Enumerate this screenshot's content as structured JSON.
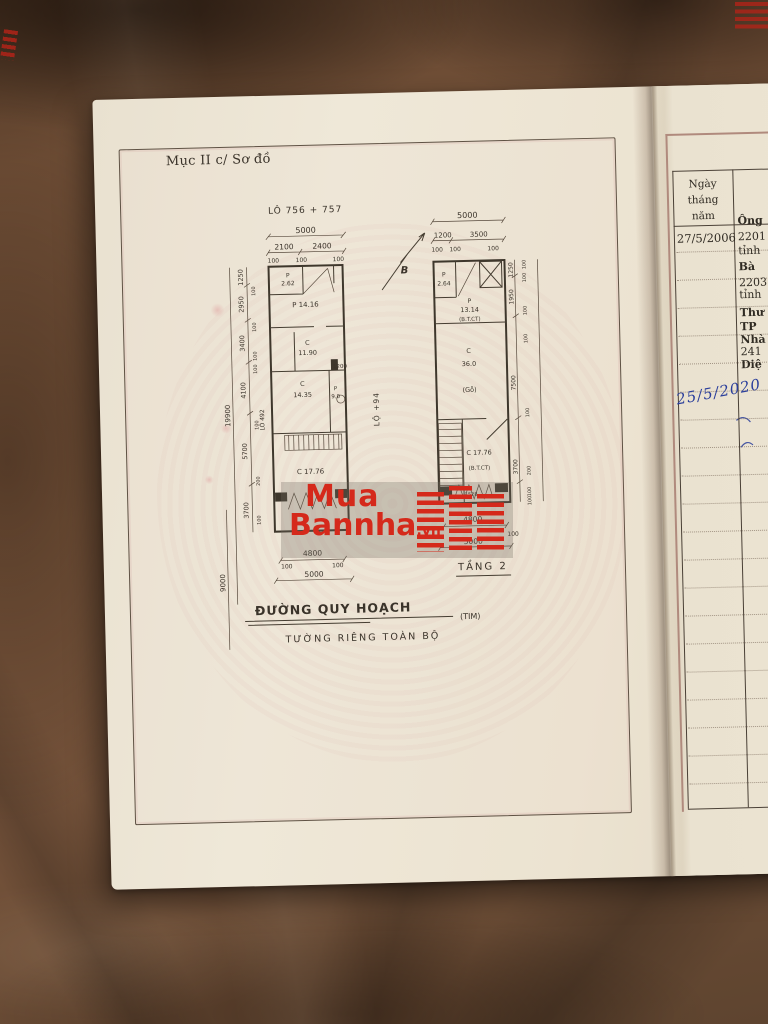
{
  "title": {
    "section": "Mục II c/ Sơ đồ"
  },
  "u": {
    "d100": "100",
    "d200": "200"
  },
  "plan1": {
    "lot": "LÔ 756 + 757",
    "top": {
      "total": "5000",
      "a": "2100",
      "b": "2400"
    },
    "rooms": {
      "p1": "P",
      "p1v": "2.62",
      "p2": "P 14.16",
      "c1": "C",
      "c1v": "11.90",
      "c2": "C",
      "c2v": "14.35",
      "wc": "P",
      "wcv": "9.0",
      "c3": "C 17.76"
    },
    "mid": {
      "d1200": "1200"
    },
    "left": {
      "a": "1250",
      "b": "2950",
      "c": "3400",
      "d": "4100",
      "e": "5700",
      "f": "3700",
      "outer": "19900",
      "outer2": "9000",
      "lot_adj": "LÔ 492"
    },
    "bottom": {
      "a": "4800",
      "total": "5000"
    },
    "alley": "LỘ +94",
    "north": "B"
  },
  "plan2": {
    "title": "TẦNG 2",
    "top": {
      "total": "5000",
      "a": "1200",
      "b": "3500"
    },
    "rooms": {
      "p1": "P",
      "p1v": "2.64",
      "p2": "P",
      "p2v": "13.14",
      "p2m": "(B.T.CT)",
      "c1": "C",
      "c1v": "36.0",
      "c1m": "(Gỗ)",
      "c2": "C 17.76",
      "c2m": "(B.T.CT)",
      "z": "1528"
    },
    "right": {
      "a": "1250",
      "b": "1950",
      "c": "7500",
      "d": "3700"
    },
    "bottom": {
      "a": "4800",
      "total": "5000"
    }
  },
  "road": {
    "name": "ĐƯỜNG QUY HOẠCH",
    "suffix": "(TIM)",
    "note": "TƯỜNG RIÊNG TOÀN BỘ"
  },
  "watermark": {
    "l1": "Mua",
    "l2": "Bannha",
    "vn": ".vn"
  },
  "right_page": {
    "header1": "Ngày tháng",
    "header2": "năm",
    "date": "27/5/2006",
    "frags": {
      "ong": "Ông",
      "n2201": "2201",
      "tinh1": "tỉnh",
      "ba": "Bà",
      "n2203": "2203",
      "tinh2": "tỉnh",
      "thu": "Thư",
      "tp": "TP",
      "nha": "Nhà",
      "n241": "241",
      "die": "Diệ"
    },
    "handwriting": "25/5/2020"
  },
  "colors": {
    "ink": "#3e372c",
    "watermark_red": "#d5291b",
    "handwriting_blue": "#2a3e9b"
  }
}
